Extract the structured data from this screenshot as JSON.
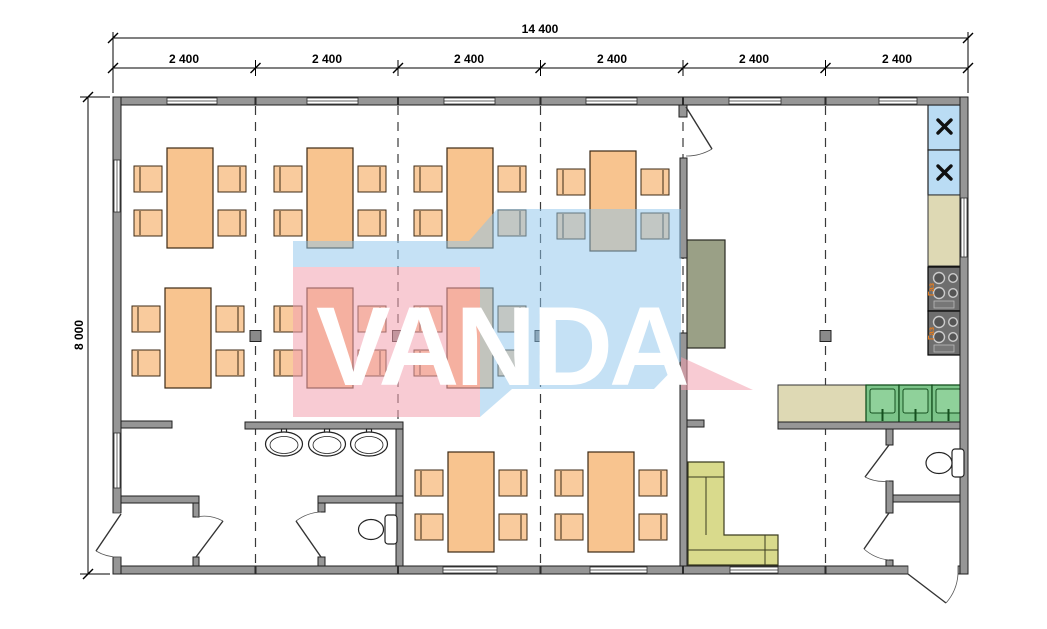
{
  "dimensions": {
    "total_width": "14 400",
    "height": "8 000",
    "segments": [
      "2 400",
      "2 400",
      "2 400",
      "2 400",
      "2 400",
      "2 400"
    ]
  },
  "watermark": {
    "text": "VANDA",
    "pink_color": "#f2a0af",
    "blue_color": "#8cc3eb"
  },
  "kitchen": {
    "stove_label": "Газ"
  },
  "furniture_counts": {
    "dining_tables": 9,
    "chairs_per_table": 4,
    "fridges": 2,
    "stoves": 2,
    "kitchen_sinks": 3,
    "wall_sinks": 3,
    "toilets": 2,
    "couches": 1
  },
  "colors": {
    "wall": "#969696",
    "table": "#f8c48f",
    "chair": "#f9cb9d",
    "couch": "#d9da8c",
    "cabinet": "#9aa086",
    "fridge": "#badcf4",
    "counter": "#ded9b4",
    "kitchen_sink_green": "#7cc489"
  }
}
